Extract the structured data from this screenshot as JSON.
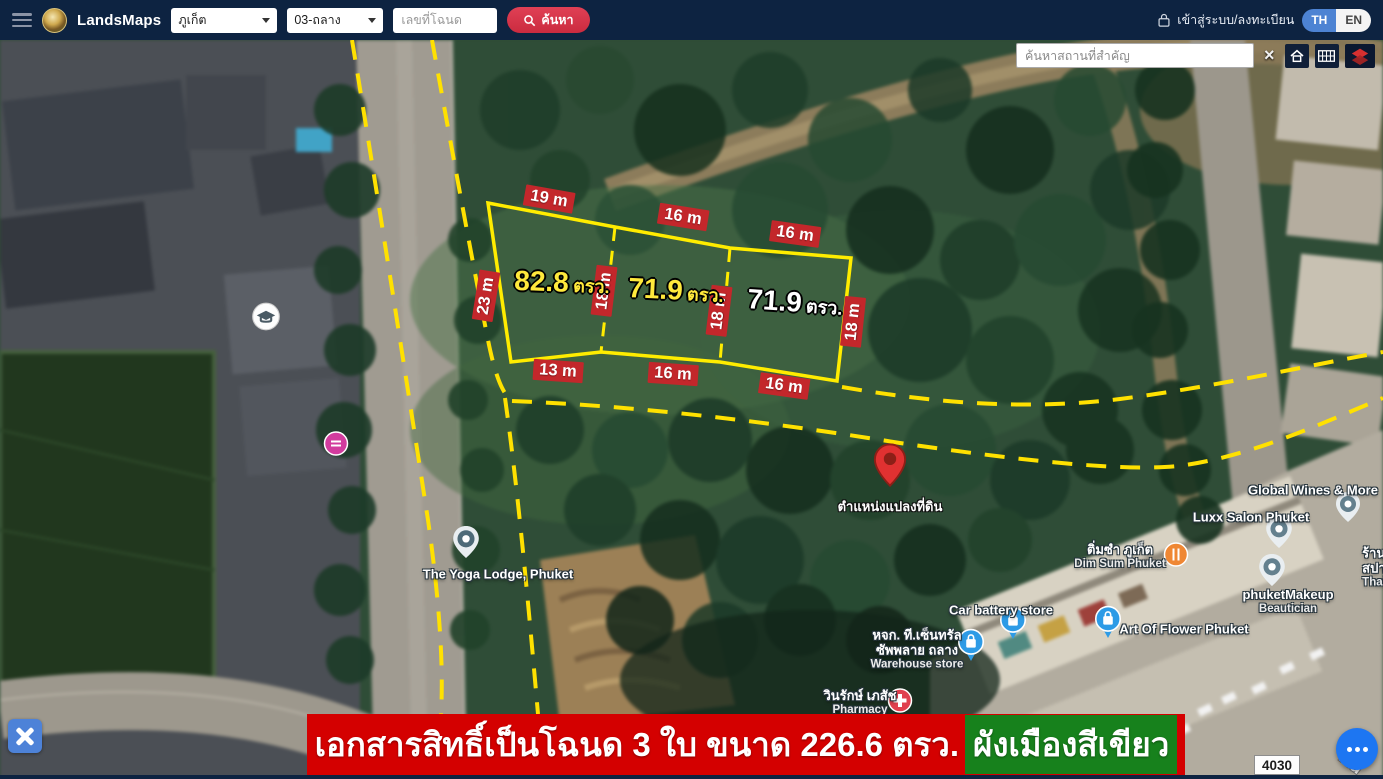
{
  "navbar": {
    "brand": "LandsMaps",
    "province_select": "ภูเก็ต",
    "branch_select": "03-ถลาง",
    "deed_input_placeholder": "เลขที่โฉนด",
    "search_button": "ค้นหา",
    "login_label": "เข้าสู่ระบบ/ลงทะเบียน",
    "lang_th": "TH",
    "lang_en": "EN"
  },
  "map_controls": {
    "place_search_placeholder": "ค้นหาสถานที่สำคัญ",
    "close": "×"
  },
  "plot_overlay": {
    "edge_labels": [
      "19 m",
      "16 m",
      "16 m",
      "23 m",
      "18 m",
      "18 m",
      "18 m",
      "13 m",
      "16 m",
      "16 m"
    ],
    "areas": [
      {
        "value": "82.8",
        "unit": "ตรว."
      },
      {
        "value": "71.9",
        "unit": "ตรว."
      },
      {
        "value": "71.9",
        "unit": "ตรว."
      }
    ],
    "pin_label": "ตำแหน่งแปลงที่ดิน"
  },
  "pois": [
    {
      "name": "The Yoga Lodge, Phuket"
    },
    {
      "name": "Global Wines & More"
    },
    {
      "name": "Luxx Salon Phuket"
    },
    {
      "name": "ติ่มซำ ภูเก็ต",
      "sub": "Dim Sum Phuket"
    },
    {
      "name": "phuketMakeup",
      "sub": "Beautician"
    },
    {
      "name": "Art Of Flower Phuket"
    },
    {
      "name": "Car battery store"
    },
    {
      "name": "หจก. ที.เซ็นทรัล",
      "name2": "ซัพพลาย ถลาง",
      "sub": "Warehouse store"
    },
    {
      "name": "วินรักษ์ เภสัช",
      "sub": "Pharmacy"
    },
    {
      "name": "ร้าน",
      "name2": "สปา",
      "sub": "Thai"
    }
  ],
  "banner": {
    "text": "เอกสารสิทธิ์เป็นโฉนด 3 ใบ ขนาด 226.6 ตรว.",
    "highlight": "ผังเมืองสีเขียว"
  },
  "route_label": "4030",
  "road_label": "Rd",
  "colors": {
    "navbar_bg": "#0d2341",
    "banner_red": "#d40000",
    "highlight_green": "#17811c",
    "plot_outline_yellow": "#ffec00",
    "measure_label_red": "#c3272b",
    "area_text_yellow": "#ffe93c",
    "accent_button_red": "#cb2b3f",
    "lang_active_blue": "#4d83d3",
    "tool_button_blue": "#4d82d8",
    "more_button_blue": "#1d76f2"
  }
}
